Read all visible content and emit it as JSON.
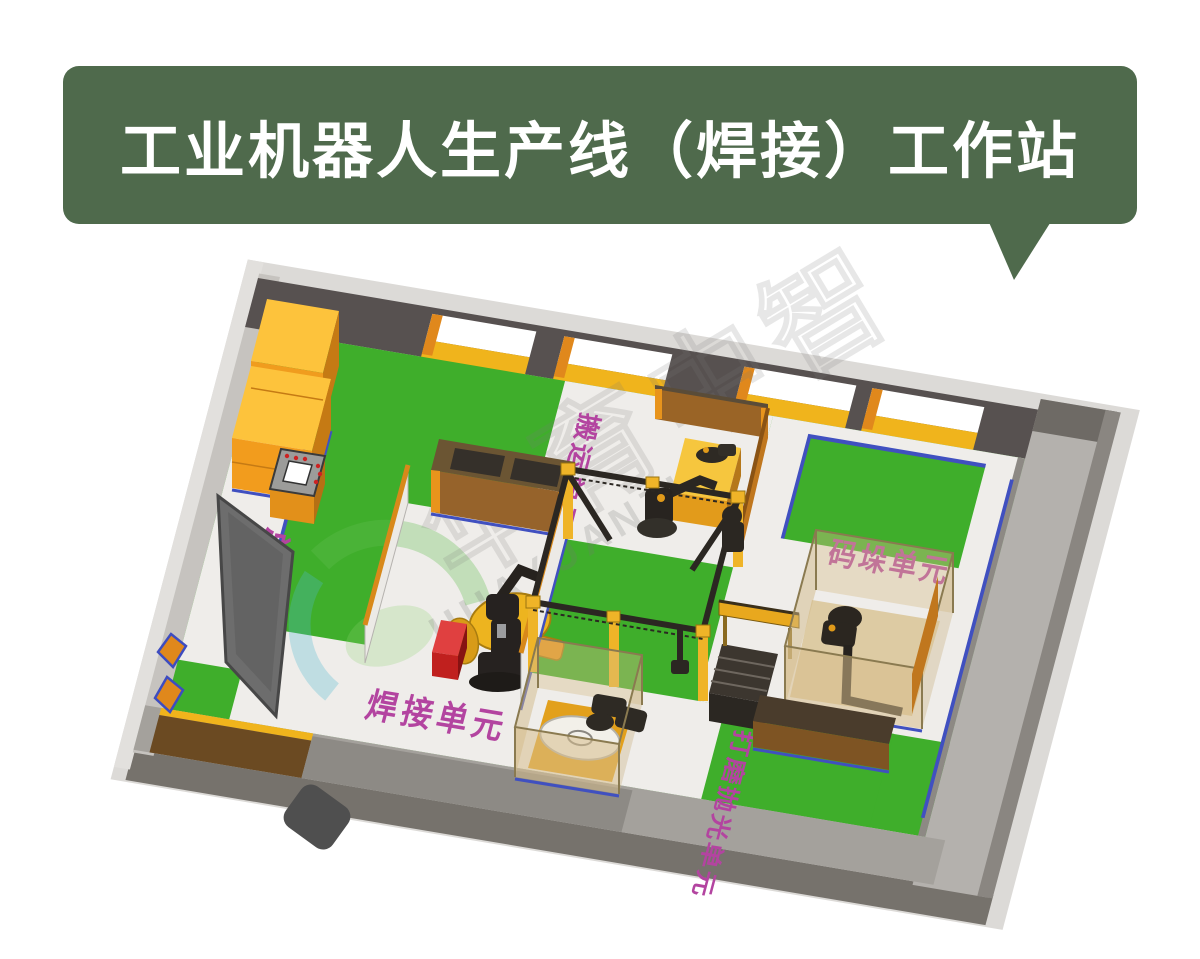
{
  "banner": {
    "title": "工业机器人生产线（焊接）工作站",
    "background_color": "#4f6a4c",
    "text_color": "#ffffff"
  },
  "floor_plan": {
    "labels": {
      "master_console": "总控台",
      "welding_unit": "焊接单元",
      "handling_unit": "搬运单元",
      "palletizing_unit": "码垛单元",
      "polishing_unit": "打磨抛光单元"
    },
    "colors": {
      "floor_green": "#3fae2b",
      "walkway_white": "#efedea",
      "wall_dark": "#575150",
      "cabinet_orange": "#f09c1e",
      "sill_yellow": "#f0b41c",
      "label_magenta": "#b344a0",
      "edge_blue": "#4050c0",
      "welder_red": "#c0201e"
    }
  },
  "watermark": {
    "cjk": "华育中智",
    "latin": "HUAYUANZHI"
  }
}
